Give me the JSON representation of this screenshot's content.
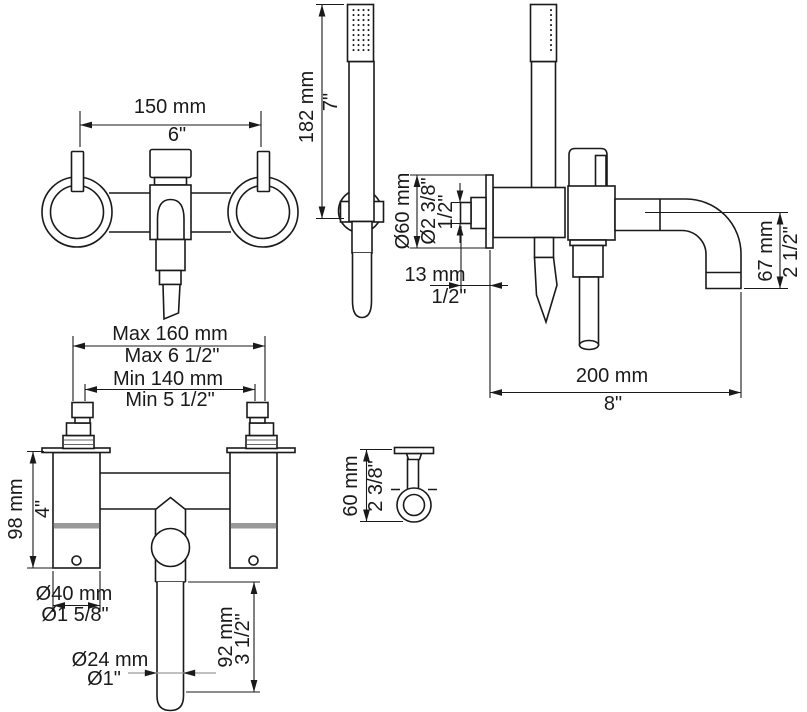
{
  "colors": {
    "line": "#1a1a1a",
    "dim_gray": "#9a9a9a",
    "background": "#ffffff"
  },
  "dims": {
    "front": {
      "width_mm": "150 mm",
      "width_in": "6\""
    },
    "hand_shower": {
      "length_mm": "182 mm",
      "length_in": "7\""
    },
    "side": {
      "flange_dia_mm": "Ø60 mm",
      "flange_dia_in": "Ø2 3/8\"",
      "connection_in": "1/2\"",
      "offset_mm": "13 mm",
      "offset_in": "1/2\"",
      "drop_mm": "67 mm",
      "drop_in": "2 1/2\"",
      "reach_mm": "200 mm",
      "reach_in": "8\""
    },
    "installation": {
      "max_mm": "Max 160 mm",
      "max_in": "Max 6 1/2\"",
      "min_mm": "Min 140 mm",
      "min_in": "Min 5 1/2\"",
      "height_mm": "98 mm",
      "height_in": "4\"",
      "flange_dia_mm": "Ø40 mm",
      "flange_dia_in": "Ø1 5/8\"",
      "spout_dia_mm": "Ø24 mm",
      "spout_dia_in": "Ø1\"",
      "spout_len_mm": "92 mm",
      "spout_len_in": "3 1/2\""
    },
    "bracket": {
      "height_mm": "60 mm",
      "height_in": "2 3/8\""
    }
  }
}
